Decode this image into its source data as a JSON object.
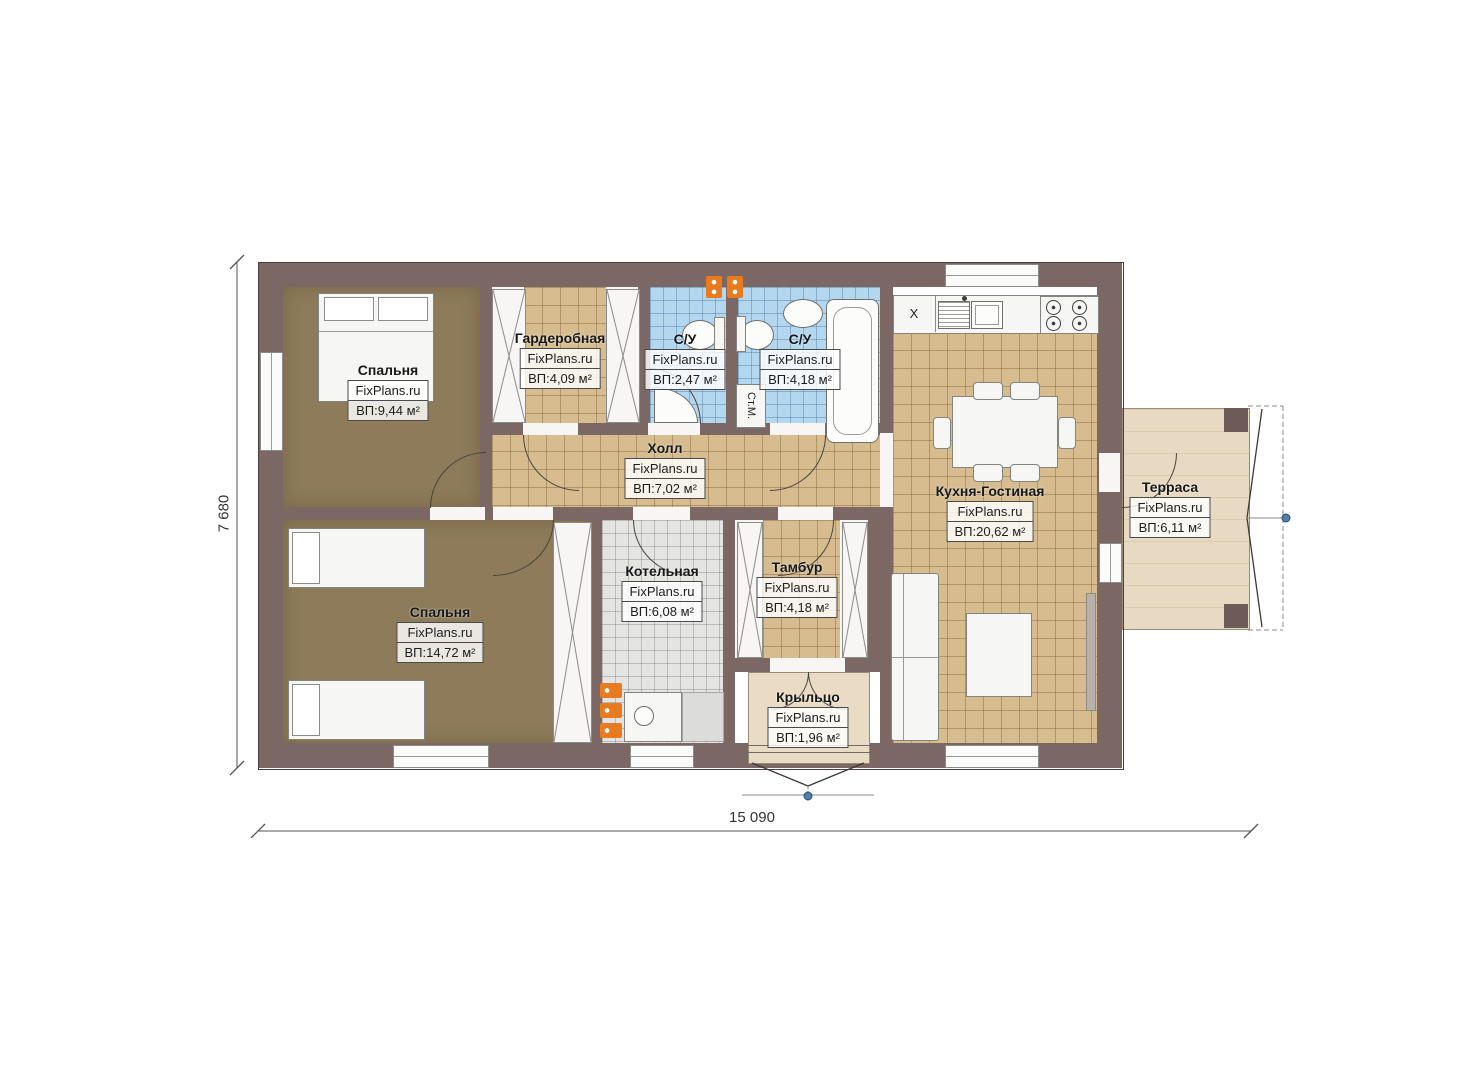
{
  "plan": {
    "type": "floor-plan",
    "source_brand": "FixPlans.ru"
  },
  "brand": "FixPlans.ru",
  "rooms": [
    {
      "name": "Спальня",
      "area": "ВП:9,44 м²"
    },
    {
      "name": "Гардеробная",
      "area": "ВП:4,09 м²"
    },
    {
      "name": "С/У",
      "area": "ВП:2,47 м²"
    },
    {
      "name": "С/У",
      "area": "ВП:4,18 м²"
    },
    {
      "name": "Холл",
      "area": "ВП:7,02 м²"
    },
    {
      "name": "Кухня-Гостиная",
      "area": "ВП:20,62 м²"
    },
    {
      "name": "Терраса",
      "area": "ВП:6,11 м²"
    },
    {
      "name": "Спальня",
      "area": "ВП:14,72 м²"
    },
    {
      "name": "Котельная",
      "area": "ВП:6,08 м²"
    },
    {
      "name": "Тамбур",
      "area": "ВП:4,18 м²"
    },
    {
      "name": "Крыльцо",
      "area": "ВП:1,96 м²"
    }
  ],
  "annotations": {
    "washing_machine": "Ст.М.",
    "counter_marker": "X"
  },
  "dimensions": {
    "width": "15 090",
    "height": "7 680"
  },
  "colors": {
    "wall": "#7b6764",
    "carpet": "#8d7b59",
    "tile_tan": "#d6bc8e",
    "tile_blue": "#b4d7f0",
    "tile_gray": "#e4e4e2",
    "terrace": "#e8dac2",
    "porch": "#eadcc4",
    "accent_orange": "#e87a20",
    "marker_blue": "#4f7dac"
  }
}
